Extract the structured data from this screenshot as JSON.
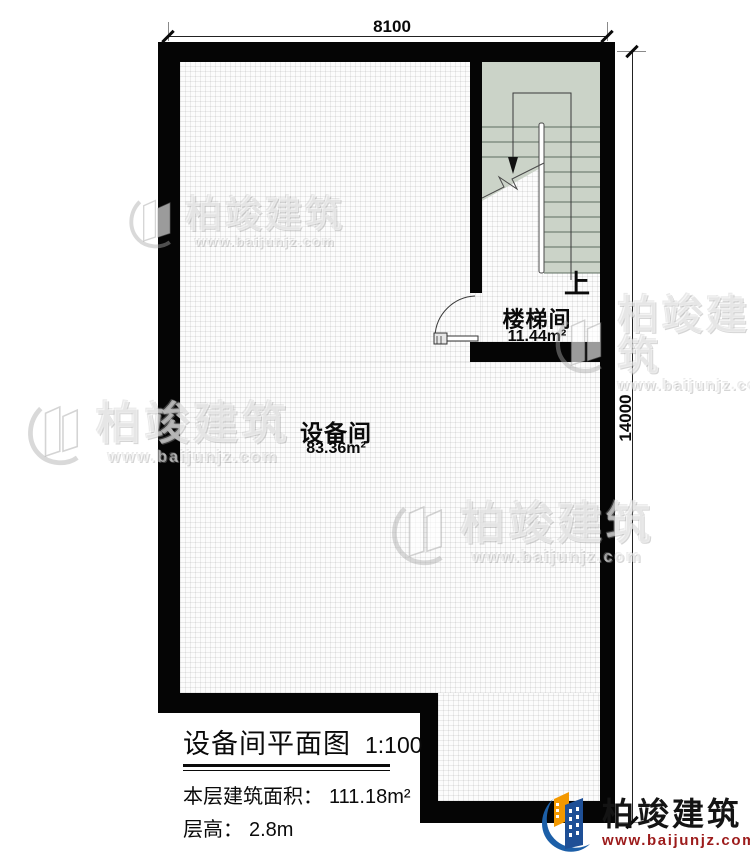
{
  "drawing": {
    "dimensions": {
      "top": "8100",
      "right": "14000"
    },
    "rooms": [
      {
        "name": "设备间",
        "area": "83.36m²"
      },
      {
        "name": "楼梯间",
        "area": "11.44m²"
      }
    ],
    "stairs": {
      "up_label": "上"
    }
  },
  "title_block": {
    "title": "设备间平面图",
    "scale": "1:100",
    "area_label": "本层建筑面积：",
    "area_value": "111.18m²",
    "floor_height_label": "层高：",
    "floor_height_value": "2.8m"
  },
  "branding": {
    "logo_text": "柏竣建筑",
    "logo_url": "www.baijunjz.com",
    "watermark_text": "柏竣建筑",
    "watermark_url": "www.baijunjz.com"
  },
  "colors": {
    "wall": "#050505",
    "stair_fill": "#cbd3c8",
    "logo_blue": "#1c5fa8",
    "logo_orange": "#f39800",
    "logo_url_red": "#9c1b1b"
  },
  "icons": {
    "logo": "building-swoosh-icon",
    "watermark": "building-swoosh-icon"
  }
}
